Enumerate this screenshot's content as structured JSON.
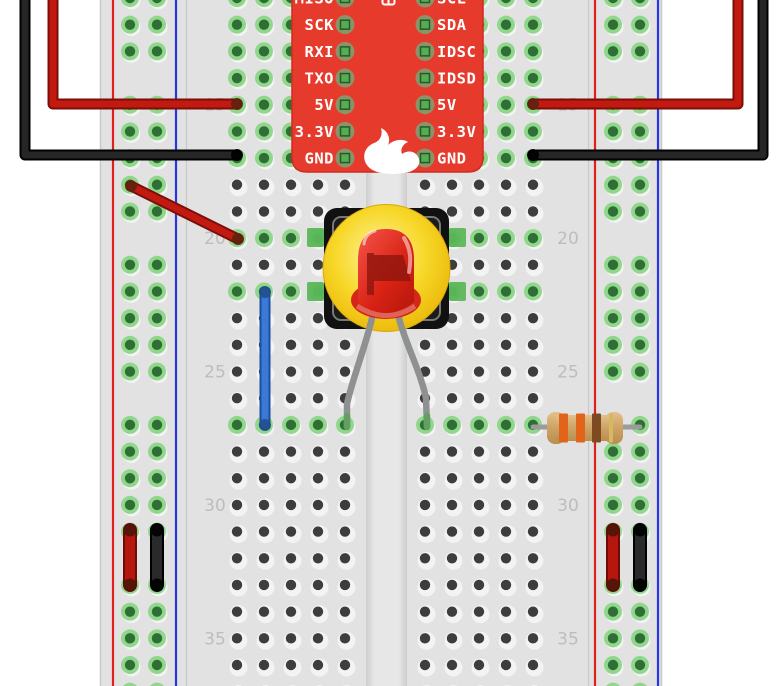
{
  "scene": {
    "width": 778,
    "height": 686,
    "background": "#ffffff",
    "kind": "fritzing-breadboard-wiring-diagram"
  },
  "board": {
    "name": "sparkfun-microcontroller",
    "color": "#e63a2d",
    "edge_color": "#d02b1f",
    "pins_left": [
      "MISO",
      "SCK",
      "RXI",
      "TXO",
      "5V",
      "3.3V",
      "GND"
    ],
    "pins_right": [
      "SCL",
      "SDA",
      "IDSC",
      "IDSD",
      "5V",
      "3.3V",
      "GND"
    ],
    "logo_icon": "sparkfun-flame-icon",
    "top_icon": "connector-icon",
    "pad_ring_color": "#8a9468",
    "pad_square_color": "#55ad52"
  },
  "breadboard": {
    "x": 100,
    "w": 562,
    "body_color": "#e2e2e2",
    "channel": {
      "x": 366,
      "w": 41
    },
    "divider_xs": [
      186,
      588
    ],
    "row_start": 11,
    "row_end": 37,
    "row0_y": -2,
    "row_dy": 26.68,
    "cols_left": [
      237,
      264,
      291,
      318,
      345
    ],
    "cols_right": [
      425,
      452,
      479,
      506,
      533
    ],
    "rail_left": {
      "red_x": 113,
      "blue_x": 176,
      "hole_xs": [
        130,
        157
      ]
    },
    "rail_right": {
      "red_x": 595,
      "blue_x": 658,
      "hole_xs": [
        613,
        640
      ]
    },
    "rail_skip_rows": [
      14,
      20,
      26,
      32
    ],
    "rail_color_positive": "#df201c",
    "rail_color_negative": "#2737dd",
    "green_rows": [
      11,
      12,
      13,
      14,
      15,
      16,
      17,
      20,
      22,
      27
    ],
    "hole_dark": "#3d3d3d",
    "hole_light": "#f3f3f3",
    "hole_green_ring": "#90d78c",
    "hole_green_center": "#2f6f35",
    "row_numbers": [
      "15",
      "20",
      "25",
      "30",
      "35"
    ],
    "row_number_rows": [
      15,
      20,
      25,
      30,
      35
    ],
    "label_x_left": 215,
    "label_x_right": 568
  },
  "components": {
    "led": {
      "name": "red-led",
      "bulb_color": "#d92315",
      "flag_color": "#8e150c",
      "flange_color": "#d42718",
      "leg_color": "#8f9191",
      "leg_tip_color": "#639e63"
    },
    "pushbutton": {
      "name": "pushbutton-with-yellow-cap",
      "body_color": "#111111",
      "inner_line_color": "#787878",
      "cap_color": "#f7d829",
      "cap_edge_color": "#d9a90b",
      "tab_color": "#5cb75a"
    },
    "resistor": {
      "name": "resistor-330ohm",
      "body_color": "#cfa568",
      "lead_color": "#9b9b9b",
      "band_names": [
        "orange",
        "orange",
        "brown",
        "gold"
      ],
      "bands": [
        "#e2641b",
        "#e2641b",
        "#7d4a22",
        "#d6b763"
      ],
      "band_xs": [
        559,
        576,
        592,
        609
      ],
      "band_ws": [
        9,
        9,
        9,
        4
      ]
    }
  },
  "wires": [
    {
      "id": "power-wire-red-left",
      "color": "#c21a10",
      "dark": "#7a0f08",
      "cap": "#5f2210",
      "points": [
        [
          53,
          -10
        ],
        [
          53,
          104
        ],
        [
          237,
          104
        ]
      ],
      "cap_points": [
        [
          237,
          104
        ]
      ]
    },
    {
      "id": "ground-wire-black-left",
      "color": "#262626",
      "dark": "#000000",
      "cap": "#000000",
      "points": [
        [
          25,
          -10
        ],
        [
          25,
          155
        ],
        [
          237,
          155
        ]
      ],
      "cap_points": [
        [
          237,
          155
        ]
      ]
    },
    {
      "id": "power-wire-red-right",
      "color": "#c21a10",
      "dark": "#7a0f08",
      "cap": "#5f2210",
      "points": [
        [
          533,
          104
        ],
        [
          738,
          104
        ],
        [
          738,
          -10
        ]
      ],
      "cap_points": [
        [
          533,
          104
        ]
      ]
    },
    {
      "id": "ground-wire-black-right",
      "color": "#262626",
      "dark": "#000000",
      "cap": "#000000",
      "points": [
        [
          533,
          155
        ],
        [
          763,
          155
        ],
        [
          763,
          -10
        ]
      ],
      "cap_points": [
        [
          533,
          155
        ]
      ]
    },
    {
      "id": "jumper-wire-red-diagonal",
      "color": "#c21a10",
      "dark": "#7a0f08",
      "cap": "#5f2210",
      "points": [
        [
          131,
          186
        ],
        [
          238,
          239
        ]
      ],
      "cap_points": [
        [
          131,
          186
        ],
        [
          238,
          239
        ]
      ]
    },
    {
      "id": "jumper-wire-blue",
      "color": "#3a79d8",
      "dark": "#1e4f9e",
      "cap": "#244e8c",
      "points": [
        [
          265,
          292
        ],
        [
          265,
          425
        ]
      ],
      "cap_points": [
        [
          265,
          292
        ],
        [
          265,
          425
        ]
      ]
    },
    {
      "id": "rail-jumper-red-left",
      "thick": true,
      "color": "#b5170e",
      "dark": "#6b0d06",
      "cap": "#4d1408",
      "points": [
        [
          130,
          530
        ],
        [
          130,
          585
        ]
      ],
      "cap_points": [
        [
          130,
          530
        ],
        [
          130,
          585
        ]
      ]
    },
    {
      "id": "rail-jumper-black-left",
      "thick": true,
      "color": "#2a2a2a",
      "dark": "#000000",
      "cap": "#000000",
      "points": [
        [
          157,
          530
        ],
        [
          157,
          585
        ]
      ],
      "cap_points": [
        [
          157,
          530
        ],
        [
          157,
          585
        ]
      ]
    },
    {
      "id": "rail-jumper-red-right",
      "thick": true,
      "color": "#b5170e",
      "dark": "#6b0d06",
      "cap": "#4d1408",
      "points": [
        [
          613,
          530
        ],
        [
          613,
          585
        ]
      ],
      "cap_points": [
        [
          613,
          530
        ],
        [
          613,
          585
        ]
      ]
    },
    {
      "id": "rail-jumper-black-right",
      "thick": true,
      "color": "#2a2a2a",
      "dark": "#000000",
      "cap": "#000000",
      "points": [
        [
          640,
          530
        ],
        [
          640,
          585
        ]
      ],
      "cap_points": [
        [
          640,
          530
        ],
        [
          640,
          585
        ]
      ]
    }
  ]
}
